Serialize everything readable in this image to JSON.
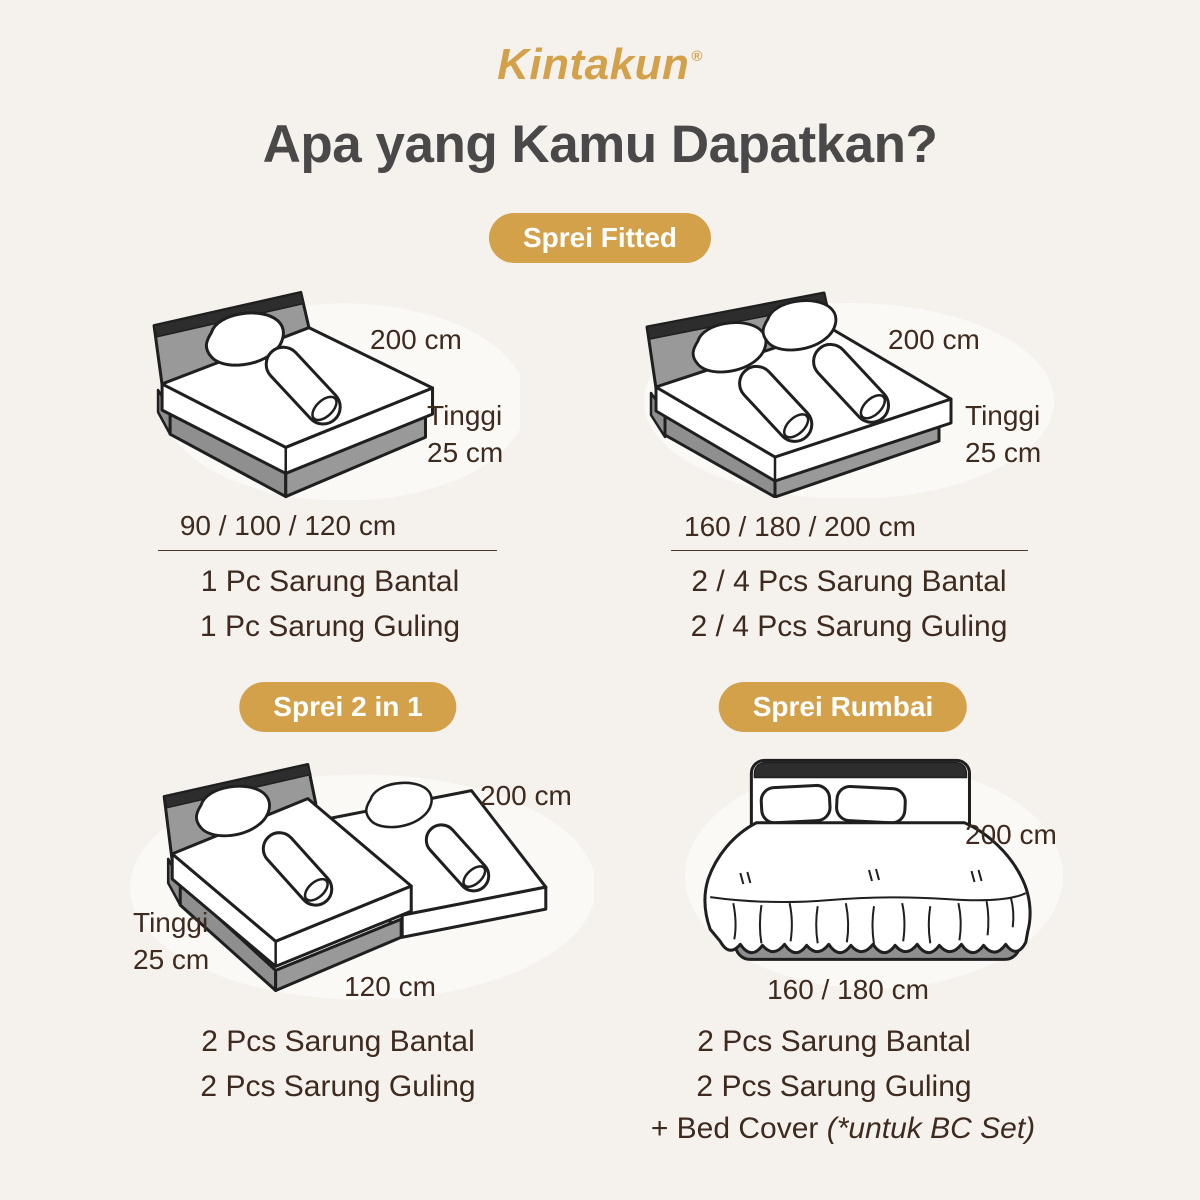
{
  "colors": {
    "background": "#f5f2ee",
    "gold": "#d4a14b",
    "title_text": "#4b4849",
    "body_text": "#3e2a1e",
    "bed_gray": "#8f8f8f",
    "outline": "#1f1f1f"
  },
  "brand": {
    "name": "Kintakun",
    "mark": "®"
  },
  "heading": "Apa yang Kamu Dapatkan?",
  "sections": {
    "fitted": {
      "badge": "Sprei Fitted",
      "single": {
        "length": "200 cm",
        "height_line1": "Tinggi",
        "height_line2": "25 cm",
        "sizes": "90 / 100 / 120 cm",
        "items": [
          "1 Pc Sarung Bantal",
          "1 Pc Sarung Guling"
        ]
      },
      "double": {
        "length": "200 cm",
        "height_line1": "Tinggi",
        "height_line2": "25 cm",
        "sizes": "160 / 180 / 200 cm",
        "items": [
          "2 / 4 Pcs Sarung Bantal",
          "2 / 4 Pcs Sarung Guling"
        ]
      }
    },
    "two_in_one": {
      "badge": "Sprei 2 in 1",
      "length": "200 cm",
      "height_line1": "Tinggi",
      "height_line2": "25 cm",
      "width": "120 cm",
      "items": [
        "2 Pcs Sarung Bantal",
        "2 Pcs Sarung Guling"
      ]
    },
    "rumbai": {
      "badge": "Sprei Rumbai",
      "length": "200 cm",
      "sizes": "160 / 180 cm",
      "items": [
        "2 Pcs Sarung Bantal",
        "2 Pcs Sarung Guling"
      ],
      "bedcover_prefix": "+ Bed Cover ",
      "bedcover_note": "(*untuk BC Set)"
    }
  }
}
